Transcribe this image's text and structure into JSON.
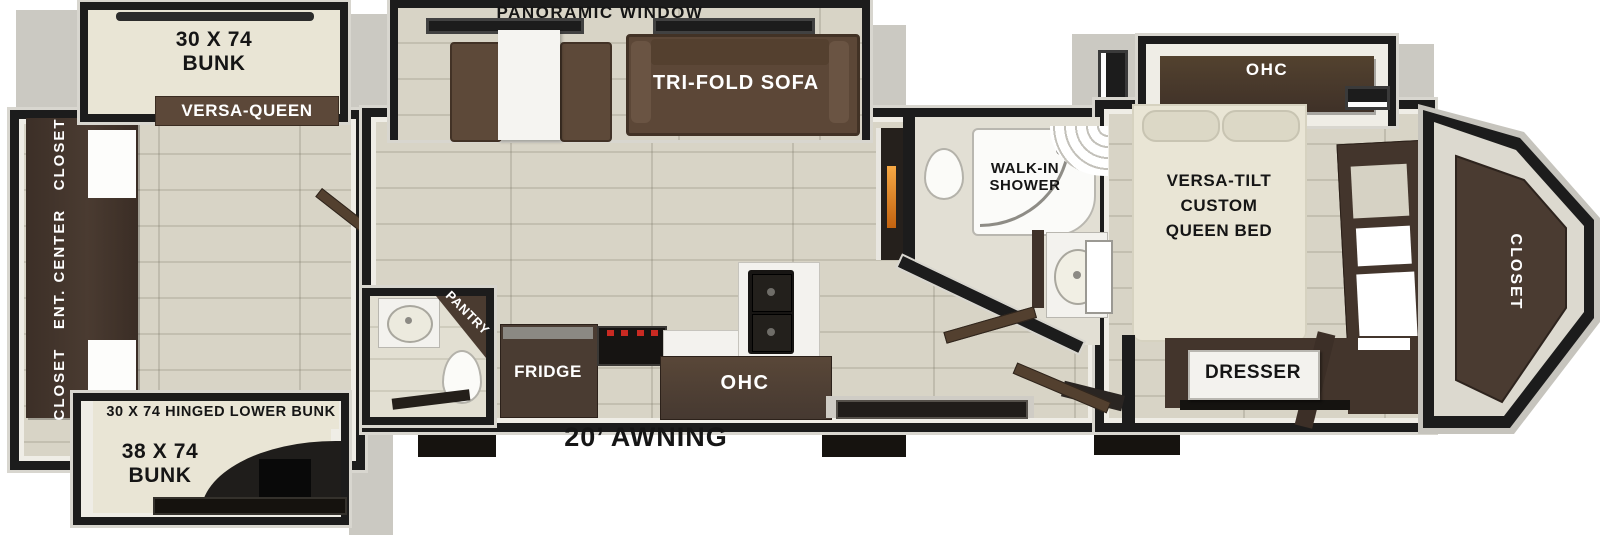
{
  "floorplan": {
    "panoramic_window": "PANORAMIC WINDOW",
    "bunk_room": {
      "top_bunk_lines": [
        "30 X 74",
        "BUNK"
      ],
      "versa_queen": "VERSA-QUEEN",
      "rear_wall_label": "CLOSET   ENT. CENTER   CLOSET",
      "hinged_lower_bunk": "30 X 74 HINGED LOWER BUNK",
      "lower_bunk_lines": [
        "38 X 74",
        "BUNK"
      ]
    },
    "living": {
      "tri_fold_sofa": "TRI-FOLD SOFA",
      "pantry": "PANTRY",
      "fridge": "FRIDGE",
      "kitchen_ohc": "OHC",
      "awning": "20’ AWNING"
    },
    "bath": {
      "walk_in_shower_lines": [
        "WALK-IN",
        "SHOWER"
      ]
    },
    "bedroom": {
      "ohc": "OHC",
      "bed_lines": [
        "VERSA-TILT",
        "CUSTOM",
        "QUEEN BED"
      ],
      "dresser": "DRESSER",
      "closet": "CLOSET"
    },
    "colors": {
      "wall": "#1c1c1c",
      "floor": "#d8d4c6",
      "cabinet_brown": "#463931",
      "sofa_brown": "#5d4939",
      "mattress": "#e9e5d5",
      "exterior_trim": "#d8d6cf"
    }
  }
}
